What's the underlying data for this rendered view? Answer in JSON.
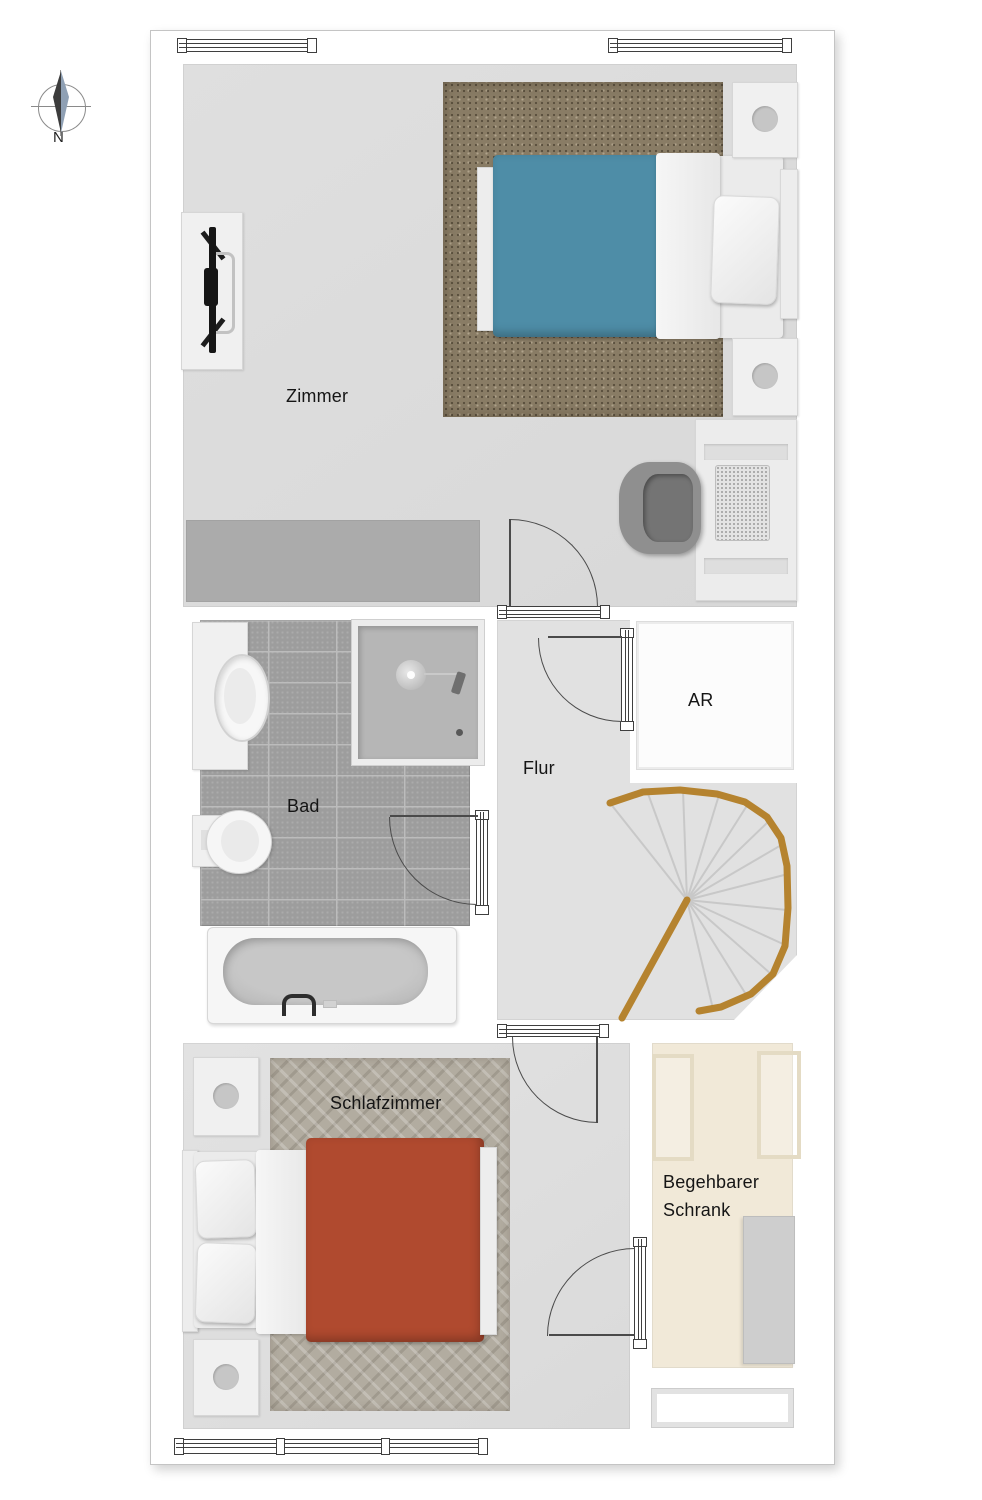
{
  "compass": {
    "label": "N"
  },
  "rooms": {
    "zimmer": {
      "label": "Zimmer"
    },
    "bad": {
      "label": "Bad"
    },
    "flur": {
      "label": "Flur"
    },
    "ar": {
      "label": "AR"
    },
    "schlafzimmer": {
      "label": "Schlafzimmer"
    },
    "schrank": {
      "line1": "Begehbarer",
      "line2": "Schrank"
    }
  },
  "palette": {
    "floor_light": "#dddddd",
    "line_dark": "#3f3f3f",
    "bed_blue": "#4e8da7",
    "bed_red": "#b04a2f",
    "rug_shag_brown": "#897c65",
    "rug_herringbone": "#b2aca0",
    "tile_gray": "#9d9d9d",
    "grout_gray": "#bcbcbc",
    "stair_rail_brown": "#b5832f",
    "closet_cream": "#f1e9d8",
    "furniture_white": "#f0f0f0",
    "dresser_gray": "#ababab"
  }
}
